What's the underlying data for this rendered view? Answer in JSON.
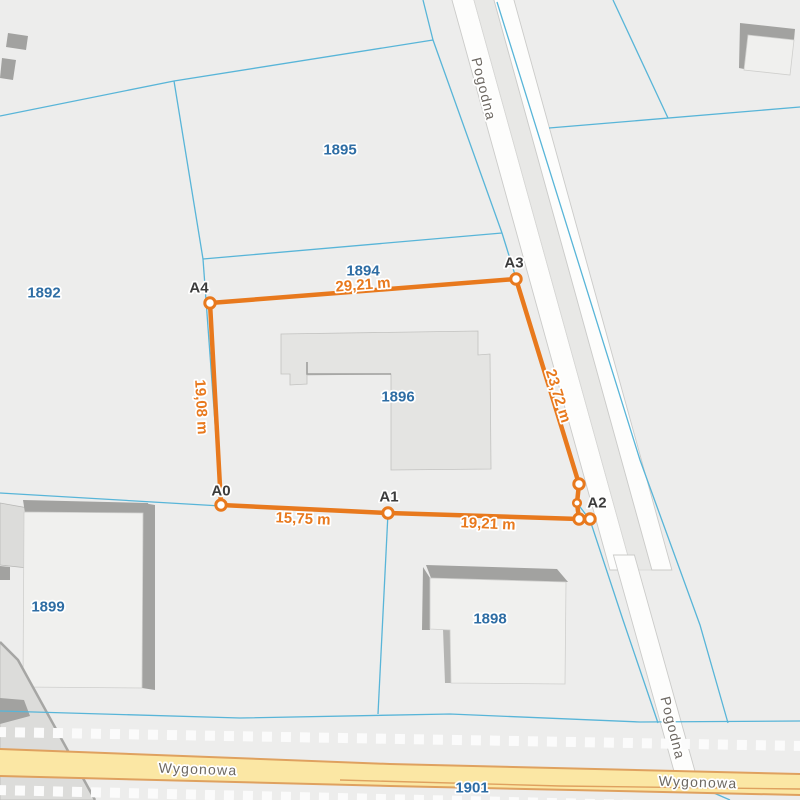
{
  "map": {
    "colors": {
      "background": "#ededec",
      "parcel_boundary": "#58b5d8",
      "measurement": "#e8791d",
      "parcel_number_text": "#2e6da4",
      "street_name_text": "#6d6862",
      "road_fill": "#fdfdfc",
      "yellow_road_fill": "#fbe7a4",
      "yellow_road_casing": "#dfa15f",
      "building_shadow": "#a2a2a0"
    },
    "parcels": [
      {
        "number": "1892"
      },
      {
        "number": "1894"
      },
      {
        "number": "1895"
      },
      {
        "number": "1896"
      },
      {
        "number": "1898"
      },
      {
        "number": "1899"
      },
      {
        "number": "1901"
      }
    ],
    "streets": [
      {
        "name": "Pogodna"
      },
      {
        "name": "Wygonowa"
      }
    ],
    "street_labels": {
      "pogodna_top": "Pogodna",
      "pogodna_bottom": "Pogodna",
      "wygonowa_left": "Wygonowa",
      "wygonowa_right": "Wygonowa"
    },
    "measurement": {
      "points": [
        {
          "label": "A0"
        },
        {
          "label": "A1"
        },
        {
          "label": "A2"
        },
        {
          "label": "A3"
        },
        {
          "label": "A4"
        }
      ],
      "segments": [
        {
          "from": "A0",
          "to": "A1",
          "length": "15,75 m"
        },
        {
          "from": "A1",
          "to": "A2",
          "length": "19,21 m"
        },
        {
          "from": "A2",
          "to": "A3",
          "length": "23,72 m"
        },
        {
          "from": "A3",
          "to": "A4",
          "length": "29,21 m"
        },
        {
          "from": "A4",
          "to": "A0",
          "length": "19,08 m"
        }
      ]
    }
  }
}
